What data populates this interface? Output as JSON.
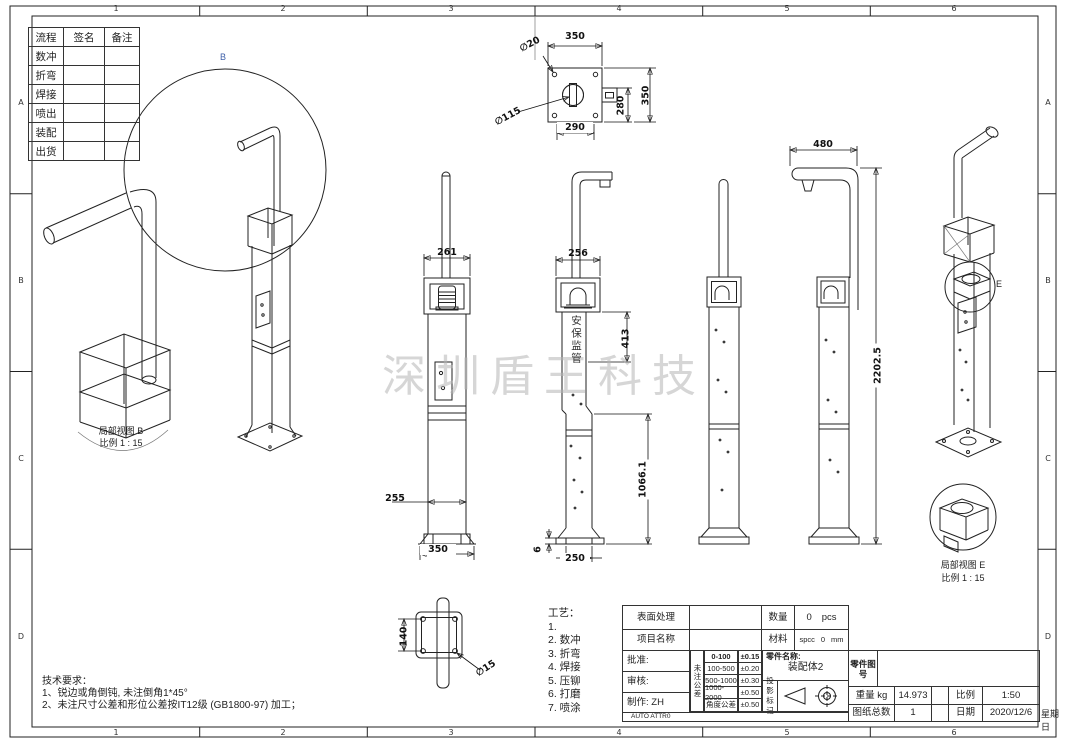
{
  "frame": {
    "zones_top": [
      "1",
      "2",
      "3",
      "4",
      "5",
      "6"
    ],
    "zones_bottom": [
      "1",
      "2",
      "3",
      "4",
      "5",
      "6"
    ],
    "rows": [
      "A",
      "B",
      "C",
      "D"
    ]
  },
  "process_table": {
    "headers": [
      "流程",
      "签名",
      "备注"
    ],
    "steps": [
      "数冲",
      "折弯",
      "焊接",
      "喷出",
      "装配",
      "出货"
    ]
  },
  "watermark": "深圳盾王科技",
  "labels": {
    "detail_b": "B",
    "detail_e": "E",
    "detail_b_caption": "局部视图 B",
    "detail_b_scale": "比例 1 : 15",
    "detail_e_caption": "局部视图 E",
    "detail_e_scale": "比例 1 : 15",
    "beacon_text": "安保监管"
  },
  "dims": {
    "top_view_width": "350",
    "top_view_bottom": "290",
    "top_view_inner_h": "280",
    "top_view_outer_h": "350",
    "top_view_hole": "∅20",
    "top_view_circle": "∅115",
    "front_box_width": "261",
    "front_pole_width": "255",
    "front_base": "350",
    "side_top_width": "256",
    "side_beacon_h": "413",
    "side_lower_h": "1066.1",
    "side_base_w": "250",
    "side_plate_t": "6",
    "arm_length": "480",
    "total_height": "2202.5",
    "flange_h": "140",
    "flange_hole": "∅15"
  },
  "tech_notes": {
    "title": "技术要求：",
    "line1": "1、锐边或角倒钝, 未注倒角1*45°",
    "line2": "2、未注尺寸公差和形位公差按IT12级 (GB1800-97) 加工；"
  },
  "process_list": {
    "title": "工艺：",
    "items": [
      "1.",
      "2. 数冲",
      "3. 折弯",
      "4. 焊接",
      "5. 压铆",
      "6. 打磨",
      "7. 喷涂"
    ]
  },
  "title_block": {
    "surface_label": "表面处理",
    "project_label": "项目名称",
    "qty_label": "数量",
    "qty_value": "0",
    "qty_unit": "pcs",
    "material_label": "材料",
    "material_value": "spcc",
    "material_num": "0",
    "material_unit": "mm",
    "approve_label": "批准:",
    "review_label": "审核:",
    "maker_label": "制作: ZH",
    "tol_title": "未注公差",
    "tol_rows": [
      {
        "range": "0-100",
        "value": "±0.15"
      },
      {
        "range": "100-500",
        "value": "±0.20"
      },
      {
        "range": "500-1000",
        "value": "±0.30"
      },
      {
        "range": "1000-2000",
        "value": "±0.50"
      },
      {
        "range": "角度公差",
        "value": "±0.50"
      }
    ],
    "part_name_label": "零件名称:",
    "part_name": "装配体2",
    "projection_label": "投影标记",
    "part_no_label": "零件图号",
    "weight_label": "重量 kg",
    "weight_value": "14.973",
    "scale_label": "比例",
    "scale_value": "1:50",
    "sheets_label": "图纸总数",
    "sheets_value": "1",
    "date_label": "日期",
    "date_value": "2020/12/6",
    "date_suffix": "星期日",
    "auto_attr": "AUTO ATTR0"
  },
  "colors": {
    "beacon_red": "#c23b2a",
    "frame_blue": "#203278",
    "pole_gray": "#c6c6c6",
    "watermark_gray": "#b5b5b5"
  }
}
